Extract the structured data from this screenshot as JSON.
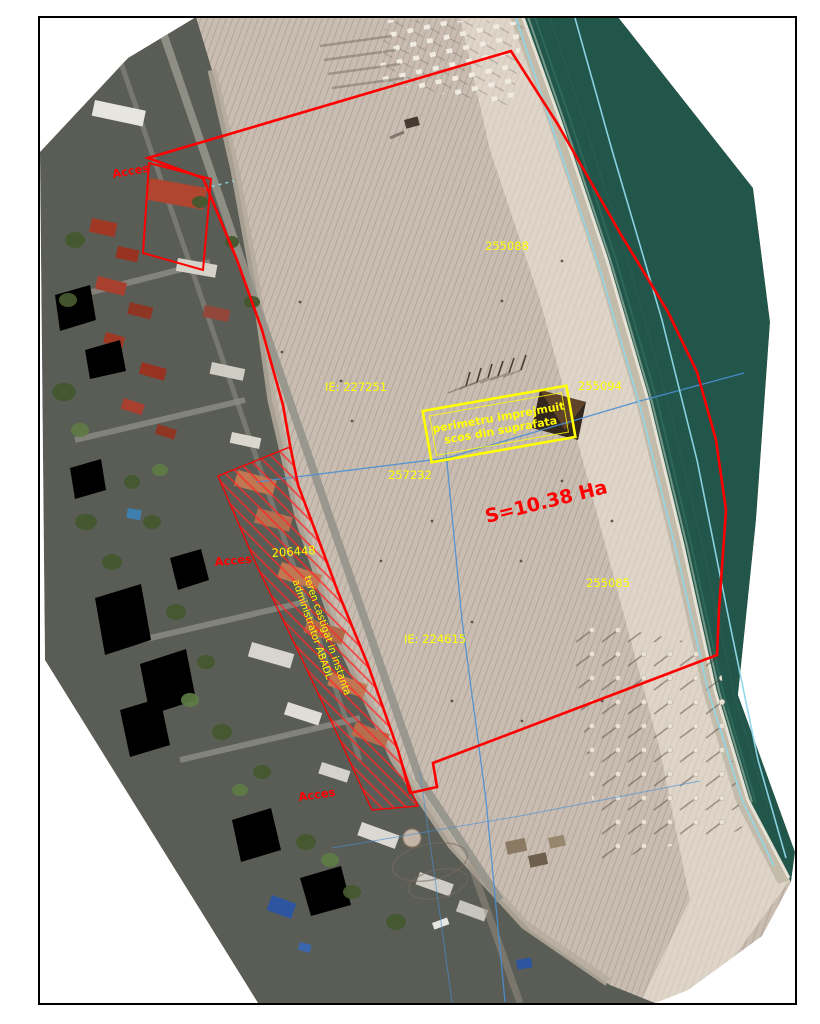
{
  "sheet": {
    "background": "#ffffff",
    "border_color": "#000000"
  },
  "map": {
    "colors": {
      "boundary_red": "#ff0000",
      "annotation_yellow": "#ffff00",
      "cadastral_blue": "#4a8fd4",
      "shoreline_cyan": "#8fd8ea",
      "sea": "#23564b",
      "sand": "#c9bdb2"
    },
    "labels": {
      "area": "S=10.38 Ha",
      "access_top": "Acces",
      "access_mid": "Acces",
      "access_bottom": "Acces",
      "parcel_255088": "255088",
      "parcel_ie_227251": "IE: 227251",
      "parcel_255094": "255094",
      "parcel_257232": "257232",
      "parcel_206448": "206448",
      "parcel_255085": "255085",
      "parcel_ie_224615": "IE: 224615",
      "enclosure_line1": "perimetru imprejmuit",
      "enclosure_line2": "scos din suprafata",
      "litigation_line1": "teren castigat in instanta",
      "litigation_line2": "administrator ABADL"
    }
  }
}
